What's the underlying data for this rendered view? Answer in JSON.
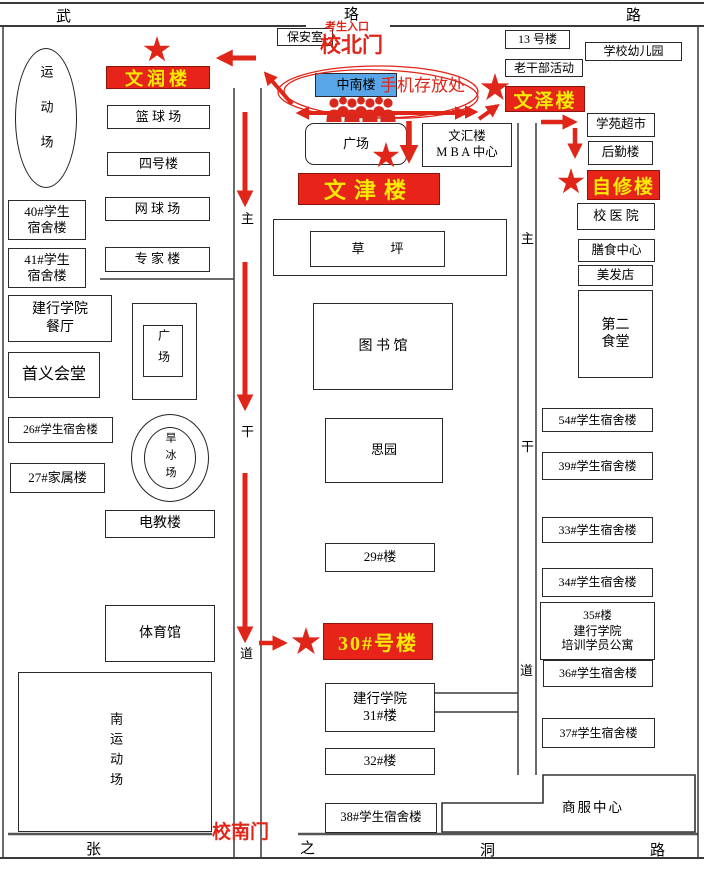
{
  "colors": {
    "red": "#e02519",
    "highlight_bg": "#e8231a",
    "highlight_text": "#ffe800",
    "zhongnan_bg": "#58a6e8",
    "road": "#3a3a3a"
  },
  "roads": {
    "top": [
      "武",
      "珞",
      "路"
    ],
    "bottom": [
      "张",
      "之",
      "洞",
      "路"
    ],
    "left_road": [
      "主",
      "干",
      "道"
    ],
    "right_road": [
      "主",
      "干",
      "道"
    ]
  },
  "gates": {
    "north": "校北门",
    "entrance_note": "考生入口",
    "south": "校南门"
  },
  "highlighted": {
    "wenrun": "文润楼",
    "wenjin": "文津楼",
    "wenze": "文泽楼",
    "zixiu": "自修楼",
    "bldg30": "30#号楼",
    "phone_storage": "手机存放处"
  },
  "buildings": {
    "sports_field": "运动场",
    "dorm40_l1": "40#学生",
    "dorm40_l2": "宿舍楼",
    "dorm41_l1": "41#学生",
    "dorm41_l2": "宿舍楼",
    "basketball": "篮 球 场",
    "no4": "四号楼",
    "tennis": "网 球 场",
    "expert": "专 家 楼",
    "ccb_canteen_l1": "建行学院",
    "ccb_canteen_l2": "餐厅",
    "shouyi": "首义会堂",
    "square_left": "广场",
    "dorm26": "26#学生宿舍楼",
    "family27": "27#家属楼",
    "skating": "旱冰场",
    "dianjiao": "电教楼",
    "gym": "体育馆",
    "south_field": "南运动场",
    "security": "保安室",
    "zhongnan": "中南楼",
    "square_mid": "广场",
    "wenhui_l1": "文汇楼",
    "wenhui_l2": "M B A 中心",
    "lawn": "草　　坪",
    "library": "图  书  馆",
    "siyuan": "思园",
    "bldg29": "29#楼",
    "ccb31_l1": "建行学院",
    "ccb31_l2": "31#楼",
    "bldg32": "32#楼",
    "dorm38": "38#学生宿舍楼",
    "bldg13": "13 号楼",
    "kindergarten": "学校幼儿园",
    "veterans": "老干部活动",
    "supermarket": "学苑超市",
    "houqin": "后勤楼",
    "hospital": "校 医 院",
    "canteen_center": "膳食中心",
    "barber": "美发店",
    "canteen2_l1": "第二",
    "canteen2_l2": "食堂",
    "dorm54": "54#学生宿舍楼",
    "dorm39": "39#学生宿舍楼",
    "dorm33": "33#学生宿舍楼",
    "dorm34": "34#学生宿舍楼",
    "b35_l1": "35#楼",
    "b35_l2": "建行学院",
    "b35_l3": "培训学员公寓",
    "dorm36": "36#学生宿舍楼",
    "dorm37": "37#学生宿舍楼",
    "shangfu": "商服中心"
  }
}
